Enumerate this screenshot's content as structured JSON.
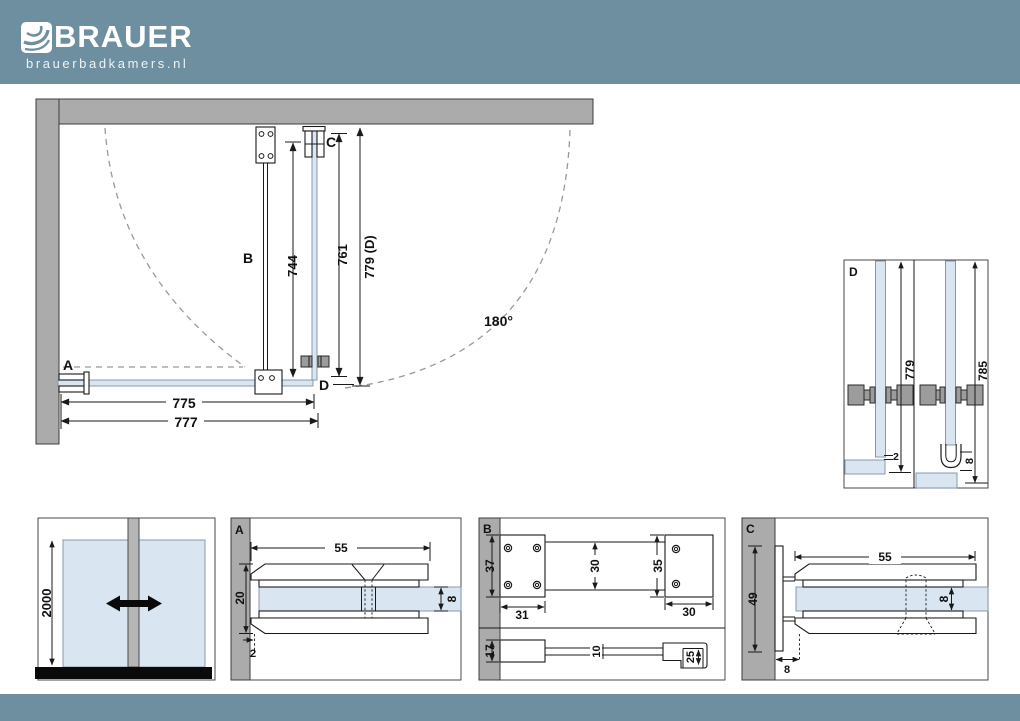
{
  "header": {
    "logo_text": "BRAUER",
    "tagline": "brauerbadkamers.nl"
  },
  "colors": {
    "brand": "#6d8fa0",
    "wall": "#ababab",
    "glass": "#d9e6f2",
    "floor": "#0a0a0a"
  },
  "plan": {
    "label_a": "A",
    "label_b": "B",
    "label_c": "C",
    "label_d": "D",
    "dim_stabilizer": "744",
    "dim_door_glass": "761",
    "dim_door_total": "779 (D)",
    "dim_glass_width": "775",
    "dim_total_width": "777",
    "swing_angle": "180°"
  },
  "detail_d": {
    "label": "D",
    "dim_left": "779",
    "dim_right": "785",
    "dim_gap": "2",
    "dim_seal": "8"
  },
  "front_view": {
    "dim_height": "2000"
  },
  "detail_a": {
    "label": "A",
    "dim_width": "55",
    "dim_height": "20",
    "dim_glass": "8",
    "dim_gap": "2"
  },
  "detail_b": {
    "label": "B",
    "dim_plate_height": "37",
    "dim_plate_width": "31",
    "dim_bar_width": "30",
    "dim_clamp_height": "35",
    "dim_clamp_width": "30",
    "dim_side_height": "17",
    "dim_bar_thickness": "10",
    "dim_hook_depth": "25"
  },
  "detail_c": {
    "label": "C",
    "dim_width": "55",
    "dim_height": "49",
    "dim_glass": "8",
    "dim_offset": "8"
  }
}
